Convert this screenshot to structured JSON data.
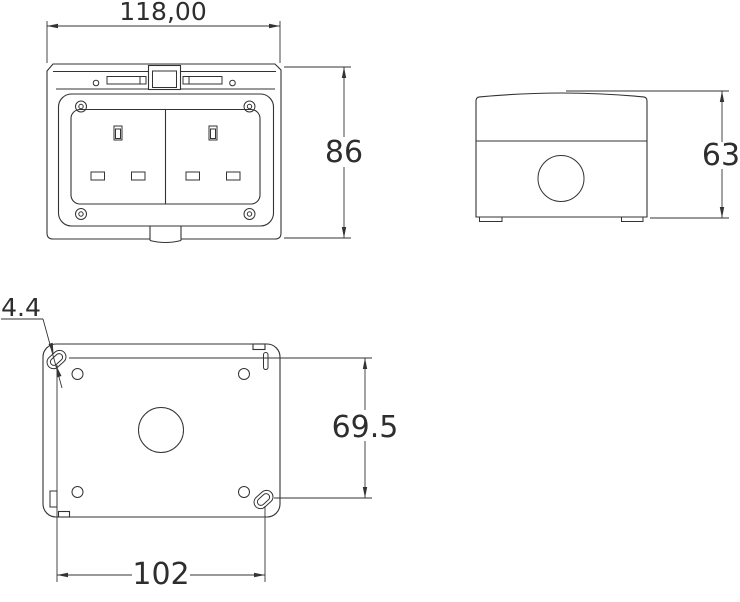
{
  "drawing": {
    "background": "#ffffff",
    "line_color": "#333333",
    "text_color": "#2e2e2e",
    "dimensions": {
      "front_width": "118,00",
      "front_height": "86",
      "side_depth": "63",
      "mount_slot_width": "4.4",
      "mount_vertical_spacing": "69.5",
      "mount_horizontal_spacing": "102"
    }
  }
}
